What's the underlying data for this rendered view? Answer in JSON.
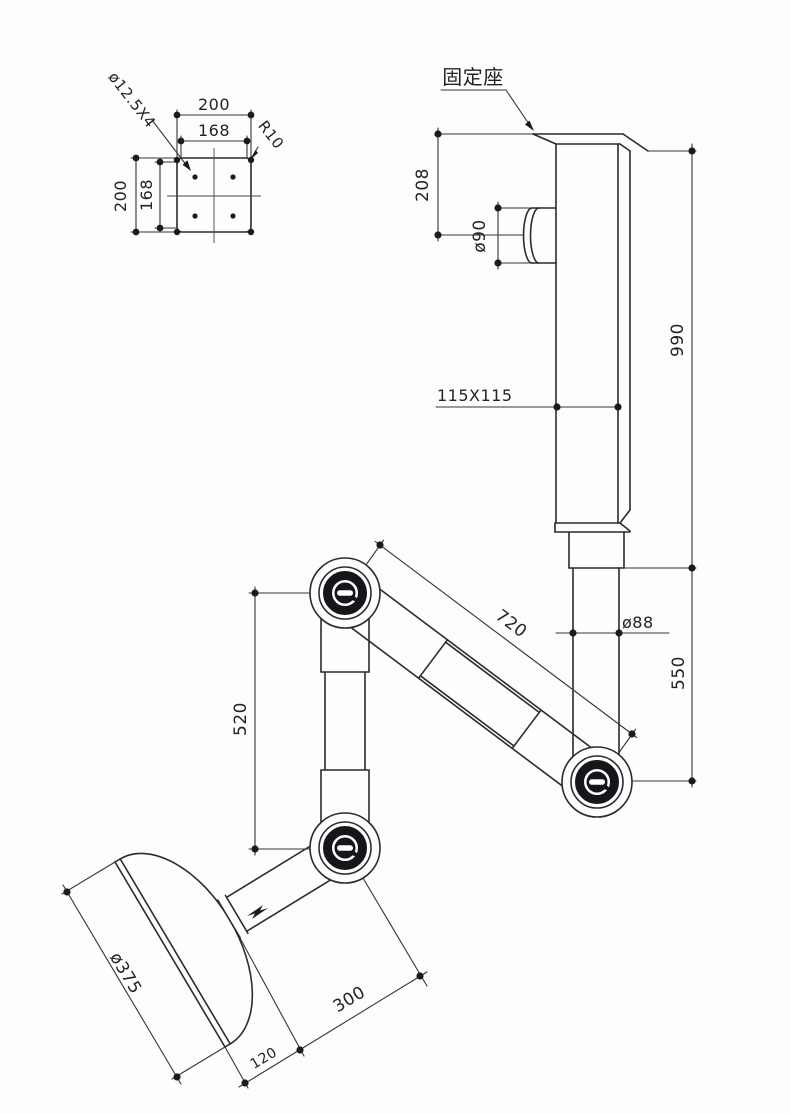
{
  "drawing": {
    "detail_view": {
      "plate_width": "200",
      "bolt_span_h": "168",
      "plate_height": "200",
      "bolt_span_v": "168",
      "hole_callout": "ø12.5X4",
      "corner_radius": "R10"
    },
    "callouts": {
      "fixed_seat": "固定座"
    },
    "dims": {
      "plate_to_pipe": "208",
      "pipe_dia": "ø90",
      "column_height": "990",
      "column_section": "115X115",
      "tube_dia": "ø88",
      "tube_height": "550",
      "upper_arm_length": "720",
      "vertical_arm_length": "520",
      "hood_dia": "ø375",
      "hood_offset": "300",
      "hood_depth": "120"
    }
  }
}
